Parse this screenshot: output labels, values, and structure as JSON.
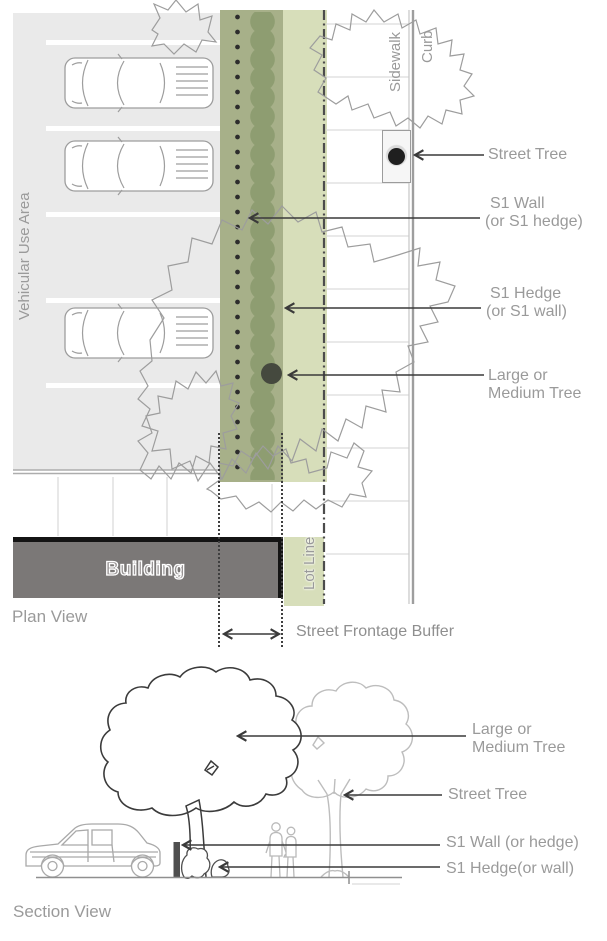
{
  "plan_view": {
    "title": "Plan View",
    "area_label": "Vehicular Use Area",
    "building_label": "Building",
    "sidewalk_label": "Sidewalk",
    "curb_label": "Curb",
    "lot_line_label": "Lot Line",
    "buffer_dimension_label": "Street Frontage Buffer",
    "callouts": {
      "street_tree": "Street Tree",
      "wall_line1": "S1 Wall",
      "wall_line2": "(or S1 hedge)",
      "hedge_line1": "S1 Hedge",
      "hedge_line2": "(or S1 wall)",
      "large_tree_line1": "Large or",
      "large_tree_line2": "Medium Tree"
    }
  },
  "section_view": {
    "title": "Section View",
    "callouts": {
      "large_tree_line1": "Large or",
      "large_tree_line2": "Medium Tree",
      "street_tree": "Street Tree",
      "wall": "S1 Wall (or hedge)",
      "hedge": "S1 Hedge(or wall)"
    }
  },
  "colors": {
    "buffer_dark": "#a7b089",
    "buffer_light": "#d7deba",
    "hedge_green": "#8e9d71",
    "tree_dot": "#45493e",
    "vehicular_gray": "#eaeaea",
    "building_gray": "#7b7877",
    "label_gray": "#9a9a9a",
    "arrow_ink": "#3a3a3a",
    "outline_gray": "#9d9d9d"
  }
}
